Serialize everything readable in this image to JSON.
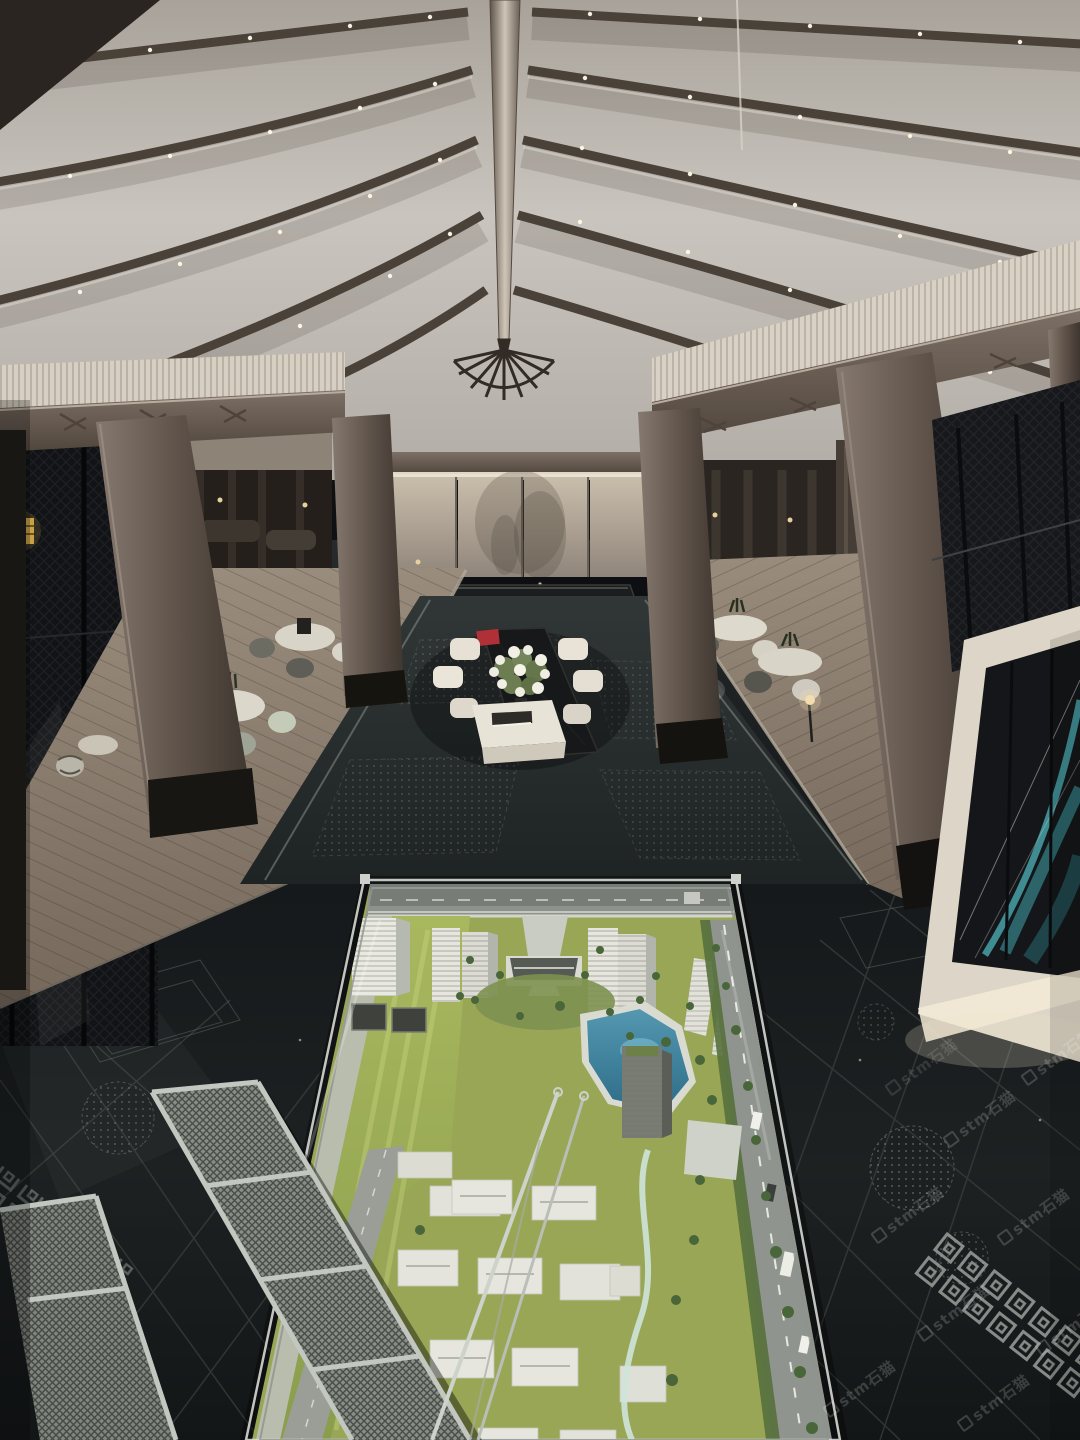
{
  "image": {
    "kind": "photograph",
    "description": "Night interior of a luxury real-estate sales gallery: tented fabric ceiling with curved timber ribs and spotlights, timber columns, backlit wall panels over night glazing, side dining areas on wood floors, a dark engraved stone floor, an illuminated teal artwork panel, and a large architectural site model with towers, pool, villas and lawns; metal mesh ramps lie in the left foreground.",
    "width": 1080,
    "height": 1440
  },
  "watermark": {
    "text": "stm石猫",
    "angle_deg": -36,
    "color": "rgba(255,255,255,0.17)",
    "count": 9
  },
  "palette": {
    "ceiling_fabric": "#c6c2bb",
    "ceiling_rib": "#4a4139",
    "wood": "#6e6258",
    "wood_floor": "#8d8172",
    "stone_floor": "#1a1d1e",
    "walkway": "#272d2d",
    "lit_panel": "#c0b5a4",
    "night_glass": "#0e0f12",
    "art_teal": "#3f8d92",
    "gold_accent": "#c9a148",
    "model_lawn": "#9fae57",
    "model_pool": "#3f7f9a",
    "model_building": "#e6e6de",
    "model_road": "#90948e",
    "flower_white": "#efece2",
    "chair_mint": "#c8cfbc",
    "accent_red": "#b03038"
  },
  "scene": {
    "ceiling": {
      "name": "tented fabric ceiling",
      "ornament": "fan-shaped ridge finial",
      "lights": "spotlights along curved ribs"
    },
    "back_wall": {
      "name": "backlit fabric panels over night glazing",
      "console": "long dark reception console on pale rug"
    },
    "dining_left": {
      "items": [
        "round table with centerpiece",
        "round table with mint chairs",
        "corner table with patterned chair",
        "black floor lamp"
      ]
    },
    "dining_right": {
      "items": [
        "round table with plant",
        "round table with plant",
        "patterned barrel chair",
        "lit candle lamp"
      ]
    },
    "lounge_center": {
      "items": [
        "dark communal table",
        "white slip-covered chairs",
        "white flower arrangement",
        "white coffee table with books",
        "red box"
      ]
    },
    "art_panel": {
      "name": "illuminated artwork with teal arcs"
    },
    "floor": {
      "name": "black stone floor engraved with meander bands and floral medallions"
    },
    "site_model": {
      "elements": [
        "perimeter road",
        "residential towers",
        "entrance pavilion",
        "swimming pool",
        "mid-rise slabs",
        "villa rows",
        "tree-lined avenue",
        "cars",
        "lawn",
        "glass railing"
      ]
    },
    "foreground": {
      "items": [
        "metal mesh ramps",
        "steel poles"
      ]
    }
  }
}
